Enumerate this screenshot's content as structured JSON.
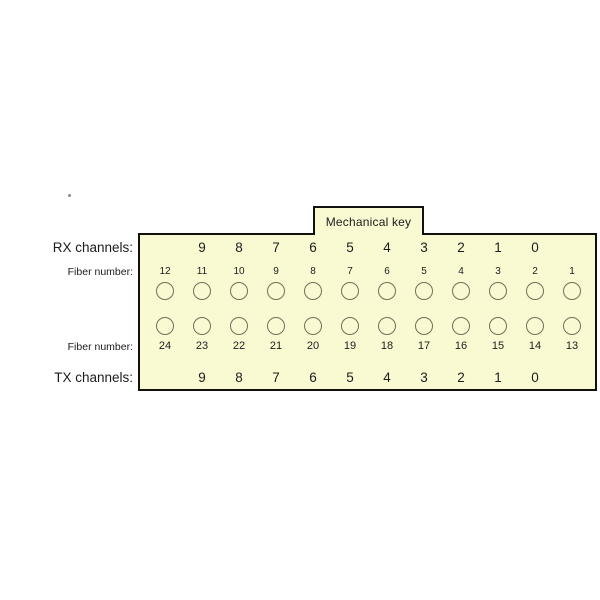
{
  "diagram": {
    "mechanical_key_label": "Mechanical key",
    "labels": {
      "rx_channels": "RX channels:",
      "fiber_number_top": "Fiber number:",
      "fiber_number_bottom": "Fiber number:",
      "tx_channels": "TX channels:"
    },
    "rx_channel_numbers": [
      "9",
      "8",
      "7",
      "6",
      "5",
      "4",
      "3",
      "2",
      "1",
      "0"
    ],
    "tx_channel_numbers": [
      "9",
      "8",
      "7",
      "6",
      "5",
      "4",
      "3",
      "2",
      "1",
      "0"
    ],
    "fiber_numbers_top": [
      "12",
      "11",
      "10",
      "9",
      "8",
      "7",
      "6",
      "5",
      "4",
      "3",
      "2",
      "1"
    ],
    "fiber_numbers_bottom": [
      "24",
      "23",
      "22",
      "21",
      "20",
      "19",
      "18",
      "17",
      "16",
      "15",
      "14",
      "13"
    ]
  },
  "colors": {
    "body_fill": "#FAFAD2",
    "border": "#111111",
    "circle_outline": "#70705a",
    "text": "#1c1c1c"
  }
}
